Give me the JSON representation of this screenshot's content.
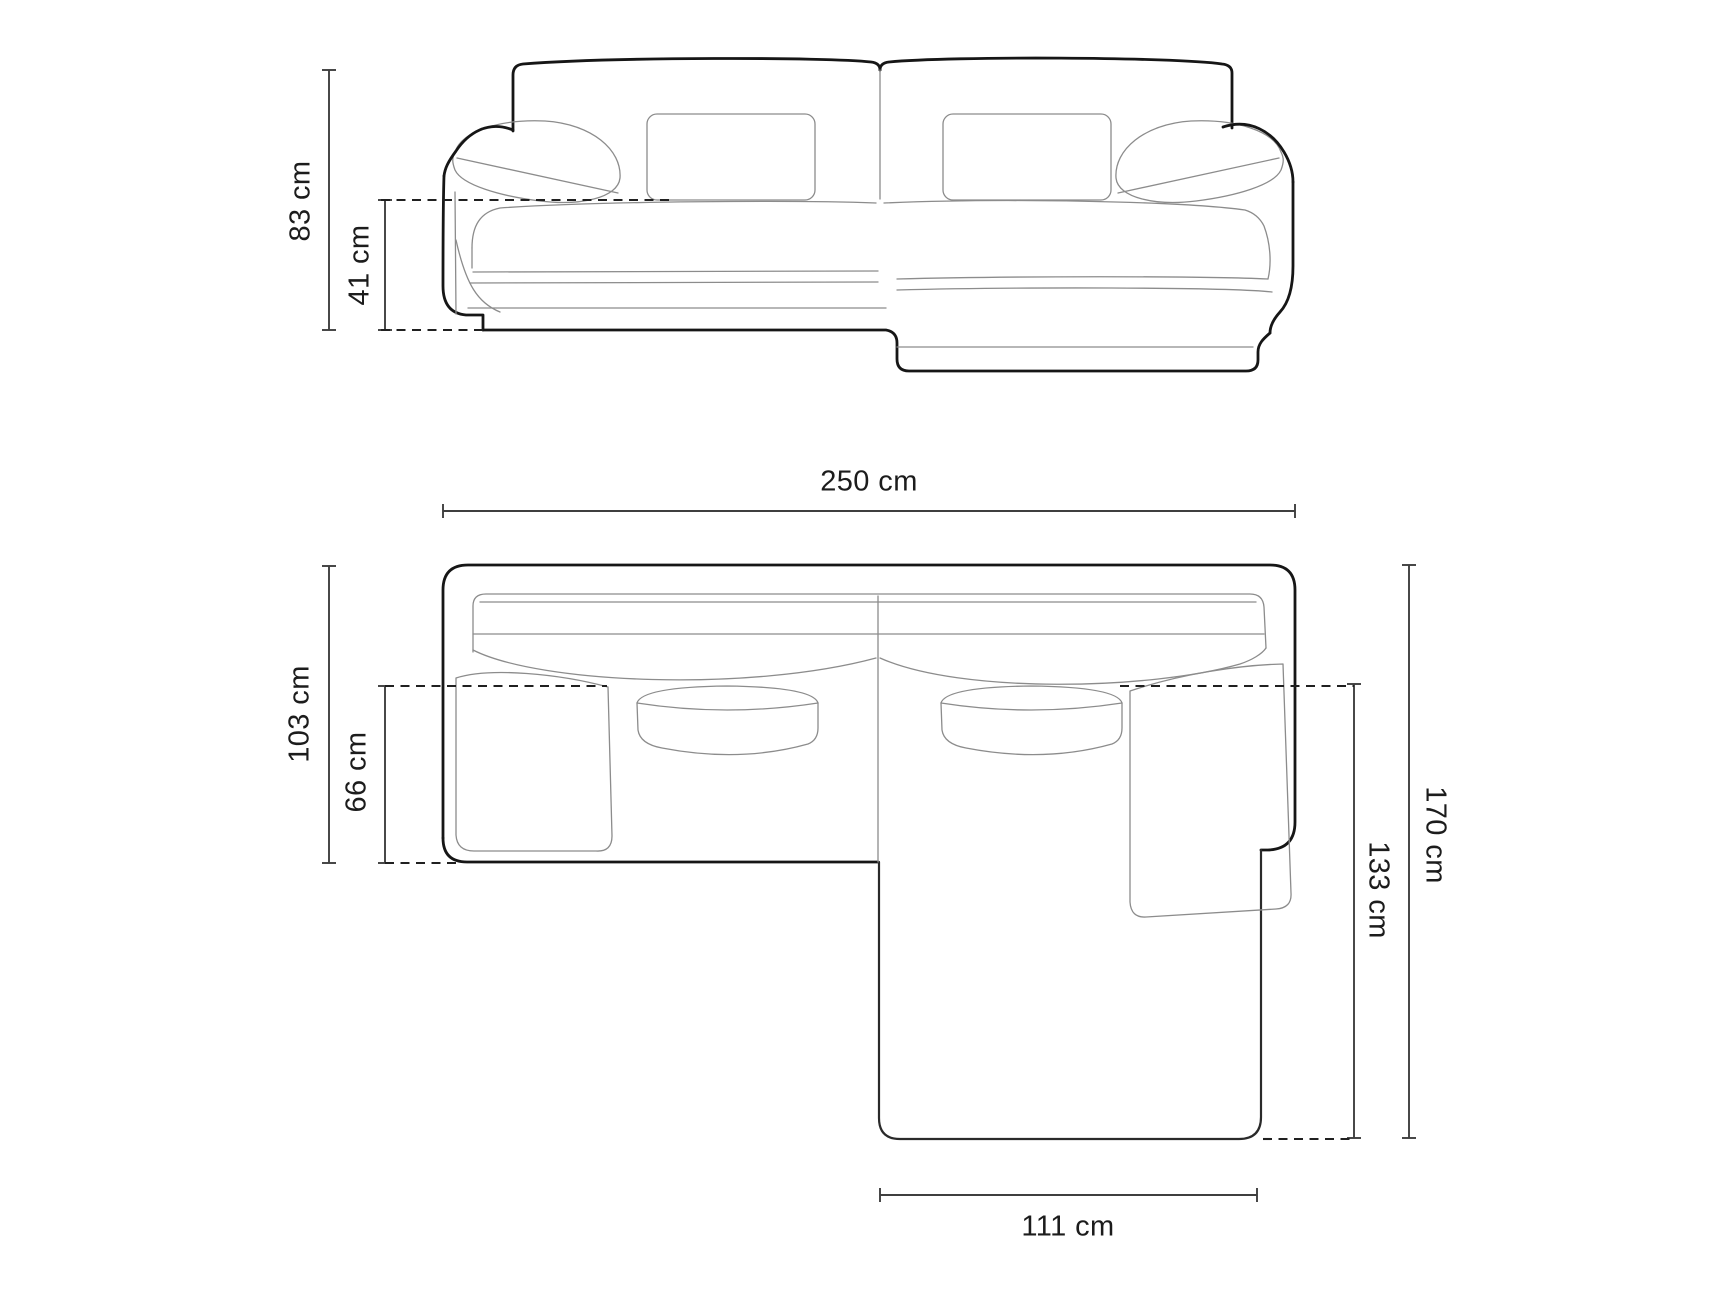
{
  "page": {
    "kind": "furniture-dimension-diagram",
    "subject": "corner sofa with chaise, line drawing, front elevation and top plan view",
    "background_color": "#ffffff"
  },
  "style": {
    "outline_color": "#161616",
    "detail_line_color": "#8c8c8c",
    "dimension_line_color": "#3f3f3f",
    "dashed_line_color": "#202020",
    "text_color": "#1c1c1c"
  },
  "front_view": {
    "name": "front-elevation",
    "dimensions": [
      {
        "id": "total-height",
        "label": "83 cm",
        "orientation": "vertical"
      },
      {
        "id": "seat-height",
        "label": "41 cm",
        "orientation": "vertical"
      }
    ]
  },
  "top_view": {
    "name": "top-plan",
    "dimensions": [
      {
        "id": "total-width",
        "label": "250 cm",
        "orientation": "horizontal"
      },
      {
        "id": "left-section-depth",
        "label": "103 cm",
        "orientation": "vertical"
      },
      {
        "id": "seat-depth",
        "label": "66 cm",
        "orientation": "vertical"
      },
      {
        "id": "total-depth",
        "label": "170 cm",
        "orientation": "vertical"
      },
      {
        "id": "chaise-depth",
        "label": "133 cm",
        "orientation": "vertical"
      },
      {
        "id": "chaise-width",
        "label": "111 cm",
        "orientation": "horizontal"
      }
    ]
  }
}
